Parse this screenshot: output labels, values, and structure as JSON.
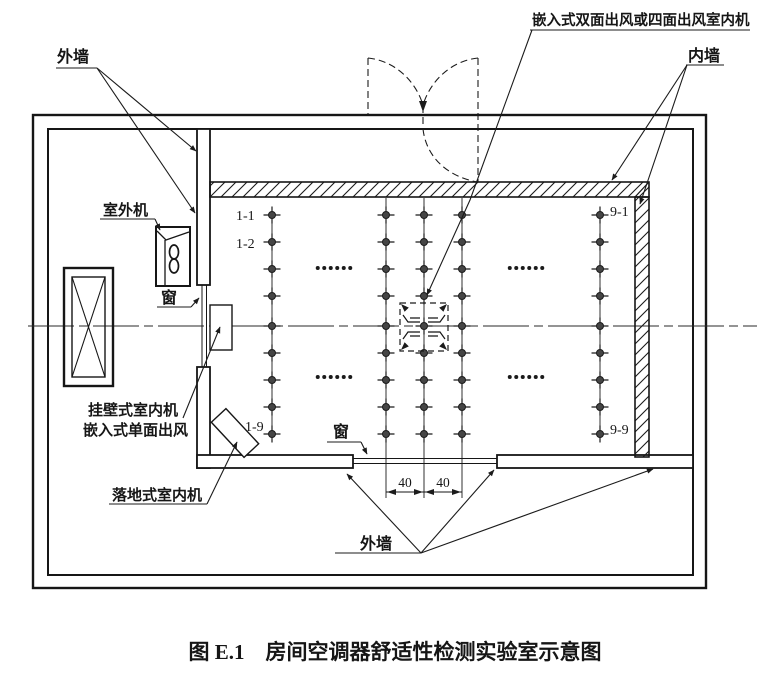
{
  "figure": {
    "caption": "图 E.1　房间空调器舒适性检测实验室示意图"
  },
  "labels": {
    "outer_wall_top": "外墙",
    "outer_wall_bottom": "外墙",
    "inner_wall": "内墙",
    "ceiling_cassette_unit": "嵌入式双面出风或四面出风室内机",
    "outdoor_unit": "室外机",
    "window_left": "窗",
    "window_bottom": "窗",
    "wall_mounted_unit": "挂壁式室内机",
    "embedded_single_outlet": "嵌入式单面出风",
    "floor_standing_unit": "落地式室内机"
  },
  "grid_labels": {
    "r1c1": "1-1",
    "r2c1": "1-2",
    "r9c1": "1-9",
    "r1c9": "9-1",
    "r9c9": "9-9"
  },
  "dimension": {
    "left": "40",
    "right": "40"
  },
  "grid": {
    "columns": [
      272,
      386,
      424,
      462,
      600
    ],
    "rows": [
      215,
      242,
      269,
      296,
      326,
      353,
      380,
      407,
      434
    ],
    "long_columns": [
      1,
      2,
      3
    ],
    "ellipsis": [
      {
        "cx": 334,
        "cy": 268
      },
      {
        "cx": 334,
        "cy": 377
      },
      {
        "cx": 526,
        "cy": 268
      },
      {
        "cx": 526,
        "cy": 377
      }
    ]
  },
  "colors": {
    "ink": "#1b1b1b",
    "paper": "#ffffff"
  }
}
